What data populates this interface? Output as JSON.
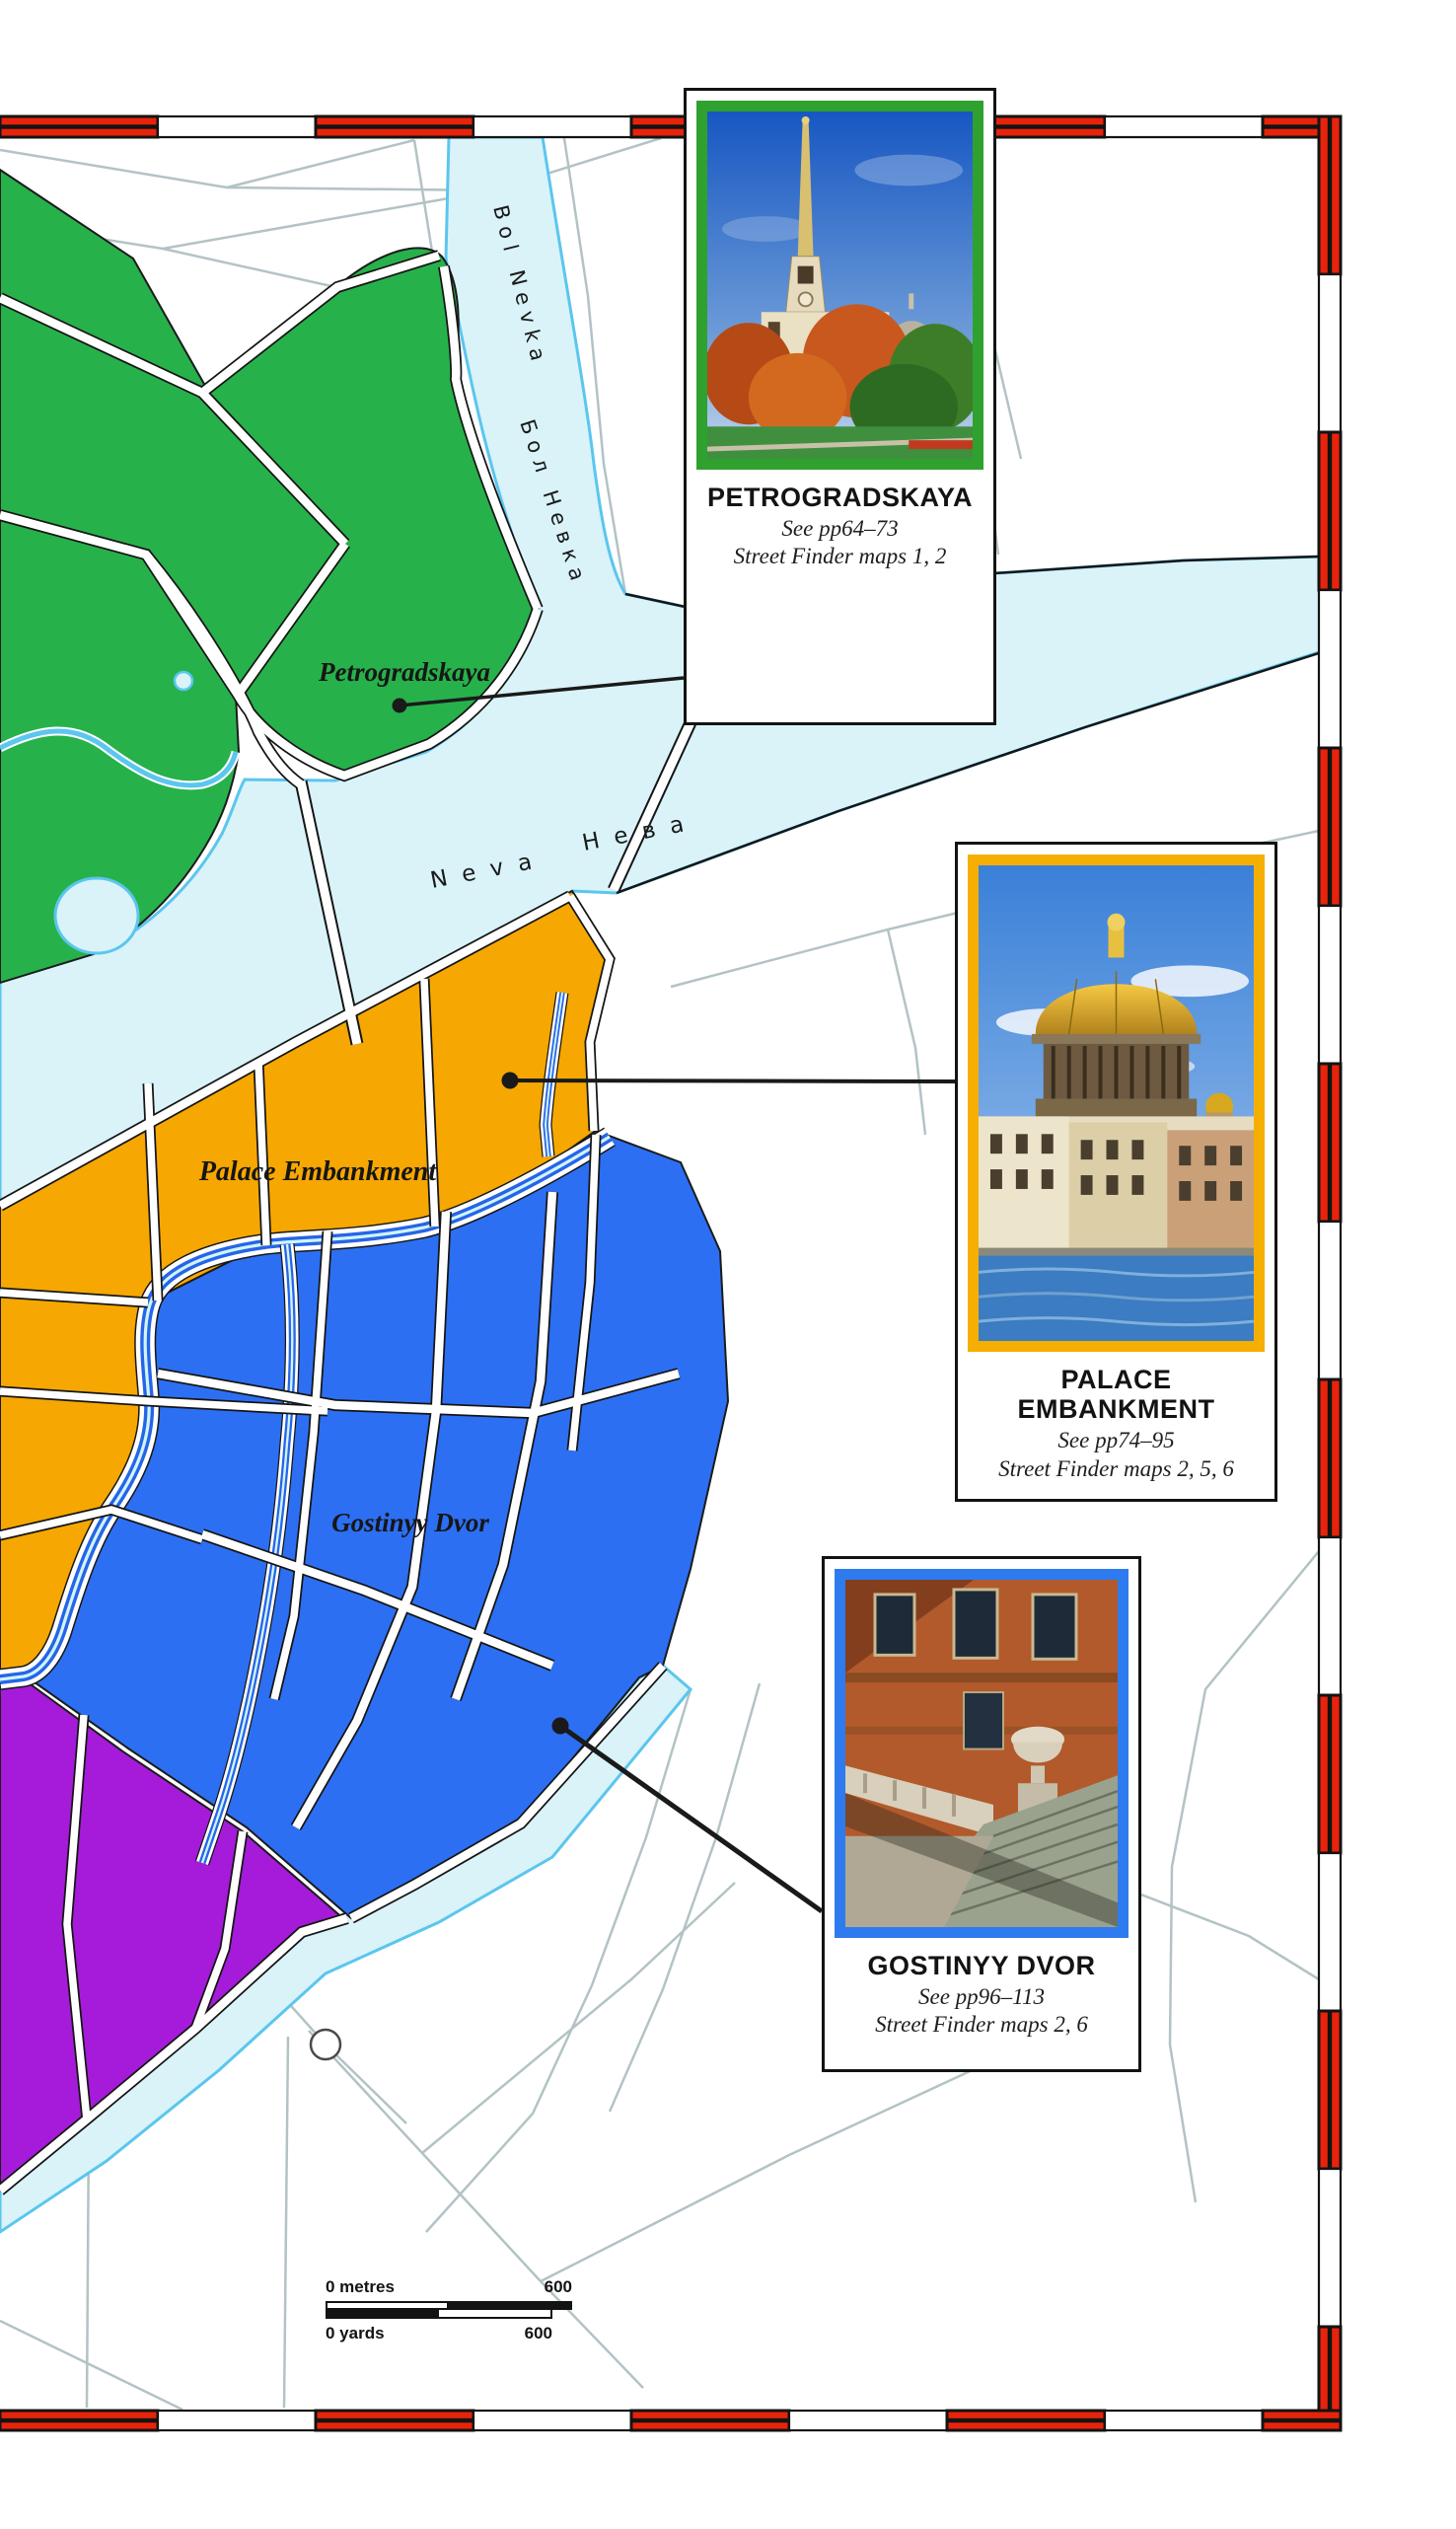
{
  "map": {
    "labels": {
      "petrogradskaya": "Petrogradskaya",
      "palace_embankment": "Palace Embankment",
      "gostinyy_dvor": "Gostinyy Dvor",
      "bol_nevka_latin": "Bol Nevka",
      "bol_nevka_cyrillic": "Бол Невка",
      "neva_latin": "Neva",
      "neva_cyrillic": "Нева"
    },
    "colors": {
      "water": "#D9F3F9",
      "water_edge": "#5BC6EE",
      "green_area": "#27B14B",
      "orange_area": "#F6A701",
      "blue_area": "#2C6FF3",
      "purple_area": "#A51BD9",
      "canal": "#2665E8",
      "border_red": "#E8230B"
    }
  },
  "callouts": [
    {
      "id": "petrogradskaya",
      "title": "PETROGRADSKAYA",
      "see": "See pp64–73",
      "maps": "Street Finder maps 1, 2",
      "frame_color": "#2FA12F"
    },
    {
      "id": "palace-embankment",
      "title": "PALACE EMBANKMENT",
      "see": "See pp74–95",
      "maps": "Street Finder maps 2, 5, 6",
      "frame_color": "#F5AF02"
    },
    {
      "id": "gostinyy-dvor",
      "title": "GOSTINYY DVOR",
      "see": "See pp96–113",
      "maps": "Street Finder maps 2, 6",
      "frame_color": "#2E7BEF"
    }
  ],
  "scale_bar": {
    "metres_label": "0 metres",
    "metres_max": "600",
    "yards_label": "0 yards",
    "yards_max": "600"
  }
}
